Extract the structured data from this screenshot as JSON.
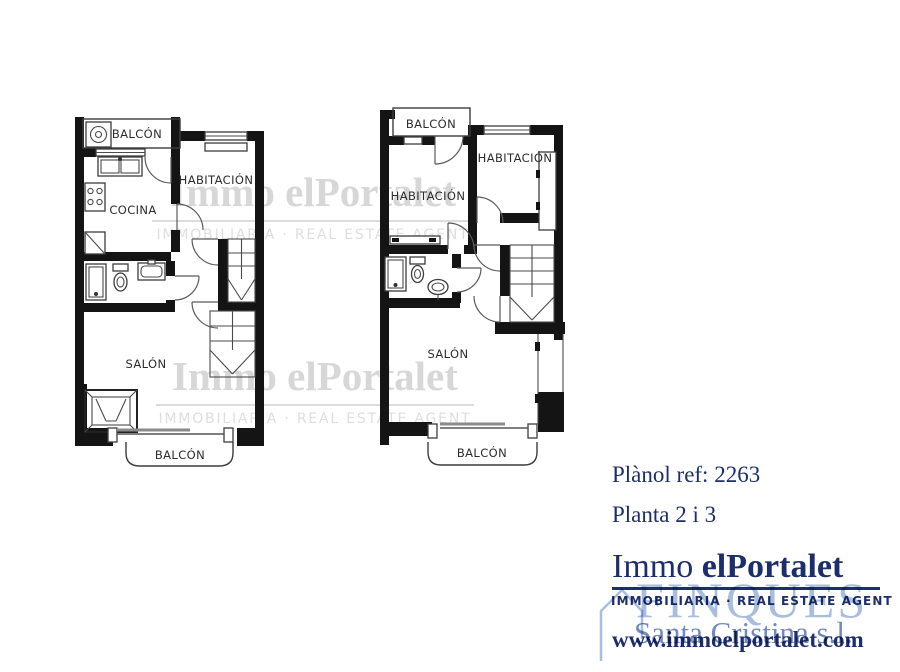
{
  "colors": {
    "wall": "#141414",
    "navy": "#1c2e6b",
    "stamp_light": "#a9bedf",
    "stamp_mid": "#7289bc",
    "watermark_gray": "#d7d7d7"
  },
  "plans": {
    "left": {
      "balcony_top": "BALCÓN",
      "habitacion": "HABITACIÓN",
      "cocina": "COCINA",
      "salon": "SALÓN",
      "balcony_bottom": "BALCÓN"
    },
    "right": {
      "balcony_top": "BALCÓN",
      "habitacion_left": "HABITACIÓN",
      "habitacion_right": "HABITACIÓN",
      "salon": "SALÓN",
      "balcony_bottom": "BALCÓN"
    }
  },
  "watermark": {
    "brand": "Immo elPortalet",
    "tagline": "IMMOBILIARIA · REAL ESTATE AGENT"
  },
  "info": {
    "ref": "Plànol ref: 2263",
    "floor": "Planta 2 i 3"
  },
  "agency": {
    "brand_regular": "Immo ",
    "brand_bold": "elPortalet",
    "tagline": "IMMOBILIARIA · REAL ESTATE AGENT",
    "website": "www.immoelportalet.com"
  },
  "stamp": {
    "line1": "FINQUES",
    "line2": "Santa Cristina s.l."
  }
}
